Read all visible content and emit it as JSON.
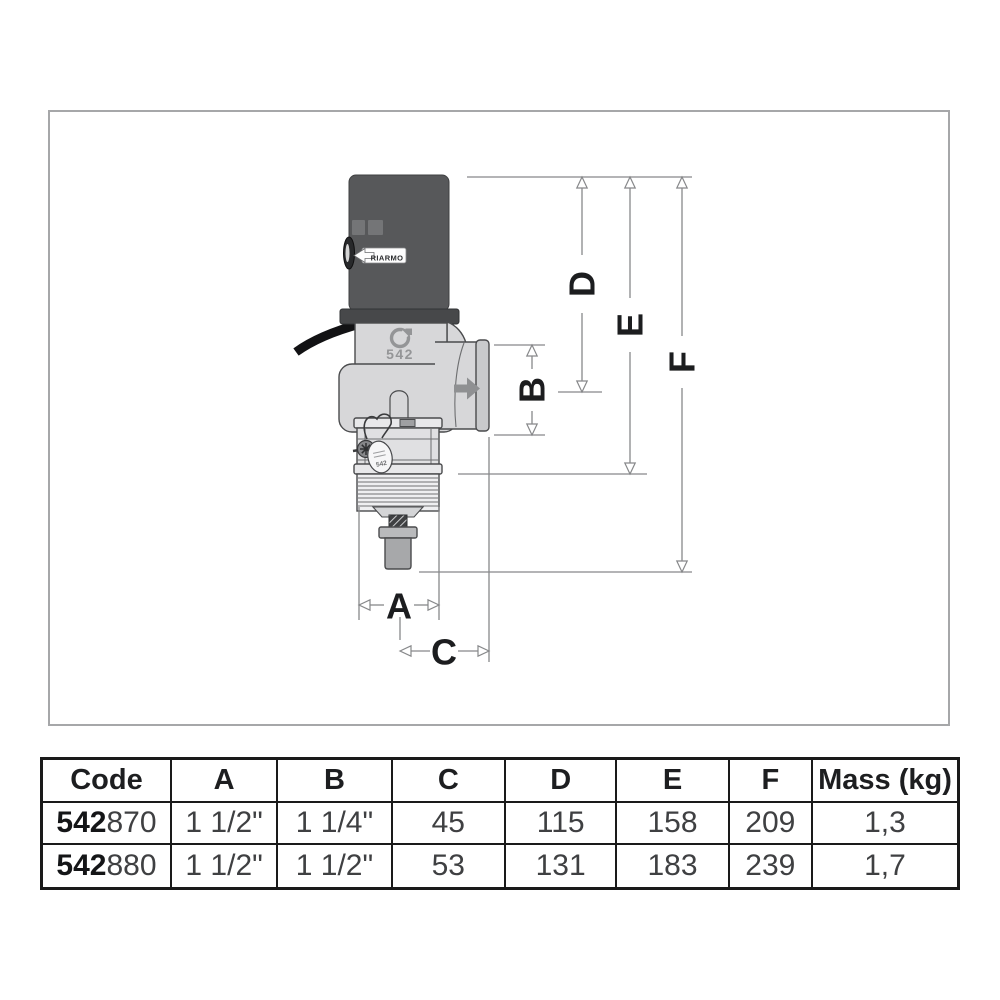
{
  "diagram": {
    "device": {
      "reset_label": "RIARMO",
      "model_number": "542",
      "seal_tag_number": "542"
    },
    "dimension_labels": {
      "a": "A",
      "b": "B",
      "c": "C",
      "d": "D",
      "e": "E",
      "f": "F"
    }
  },
  "table": {
    "headers": [
      "Code",
      "A",
      "B",
      "C",
      "D",
      "E",
      "F",
      "Mass (kg)"
    ],
    "rows": [
      {
        "code_prefix": "542",
        "code_suffix": "870",
        "a": "1 1/2\"",
        "b": "1 1/4\"",
        "c": "45",
        "d": "115",
        "e": "158",
        "f": "209",
        "mass": "1,3"
      },
      {
        "code_prefix": "542",
        "code_suffix": "880",
        "a": "1 1/2\"",
        "b": "1 1/2\"",
        "c": "53",
        "d": "131",
        "e": "183",
        "f": "239",
        "mass": "1,7"
      }
    ]
  },
  "colors": {
    "actuator_body": "#57585a",
    "valve_body": "#d7d7d9",
    "dimension_line": "#87888a",
    "table_border": "#1a1a1a",
    "label_text": "#1c1d1f"
  }
}
